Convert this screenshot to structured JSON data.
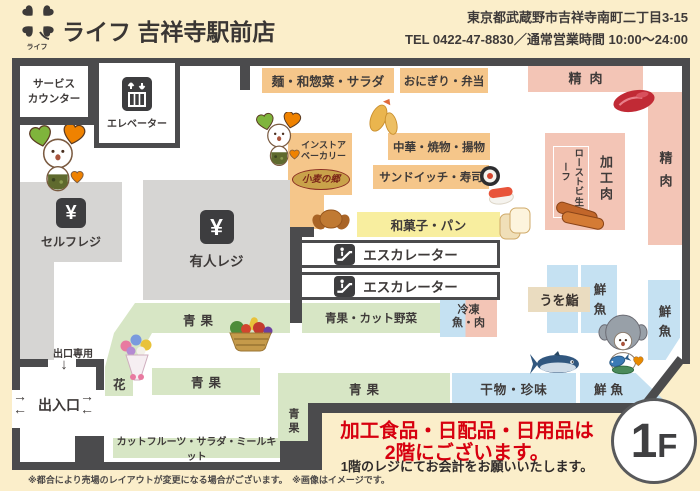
{
  "header": {
    "logo_small_text": "ライフ",
    "store_name": "ライフ 吉祥寺駅前店",
    "address": "東京都武蔵野市吉祥寺南町二丁目3-15",
    "tel_hours": "TEL 0422-47-8830／通常営業時間 10:00～24:00"
  },
  "facilities": {
    "service_counter_line1": "サービス",
    "service_counter_line2": "カウンター",
    "elevator": "エレベーター",
    "escalator": "エスカレーター",
    "self_register": "セルフレジ",
    "manned_register": "有人レジ",
    "exit_only": "出口専用",
    "entrance": "出入口"
  },
  "sections": {
    "noodle_deli_salad": "麺・和惣菜・サラダ",
    "onigiri_bento": "おにぎり・弁当",
    "meat": "精肉",
    "processed_meat": "加工肉",
    "roast_beef": "ローストビーフ",
    "raw_ham": "生ハム",
    "chinese_grill_fried": "中華・焼物・揚物",
    "sandwich_sushi": "サンドイッチ・寿司",
    "instore_bakery_line1": "インストア",
    "instore_bakery_line2": "ベーカリー",
    "bakery_brand": "小麦の郷",
    "wagashi_bread": "和菓子・パン",
    "produce": "青果",
    "produce_cut": "青果・カット野菜",
    "frozen_line1": "冷凍",
    "frozen_line2": "魚・肉",
    "uwo_sushi": "うを鮨",
    "fresh_fish": "鮮魚",
    "flower": "花",
    "cut_fruit_salad_mealkit": "カットフルーツ・サラダ・ミールキット",
    "dried_fish_delicacy": "干物・珍味"
  },
  "notice": {
    "line1": "加工食品・日配品・日用品は",
    "line2": "2階にございます。",
    "checkout": "1階のレジにてお会計をお願いいたします。",
    "floor_badge_number": "1",
    "floor_badge_letter": "F",
    "footnote": "※都合により売場のレイアウトが変更になる場合がございます。　※画像はイメージです。"
  },
  "glyphs": {
    "yen": "¥",
    "arrow_down": "↓",
    "arrow_right": "→",
    "arrow_left": "←"
  },
  "colors": {
    "accent_red": "#d7000f",
    "wall": "#4b4b4d",
    "deli_orange": "#f5c68a",
    "meat_pink": "#f3c5b6",
    "bakery_yellow": "#f8ee9f",
    "produce_green": "#d7e6c5",
    "fish_blue": "#c5e1f2",
    "register_gray": "#d6d5d3"
  }
}
